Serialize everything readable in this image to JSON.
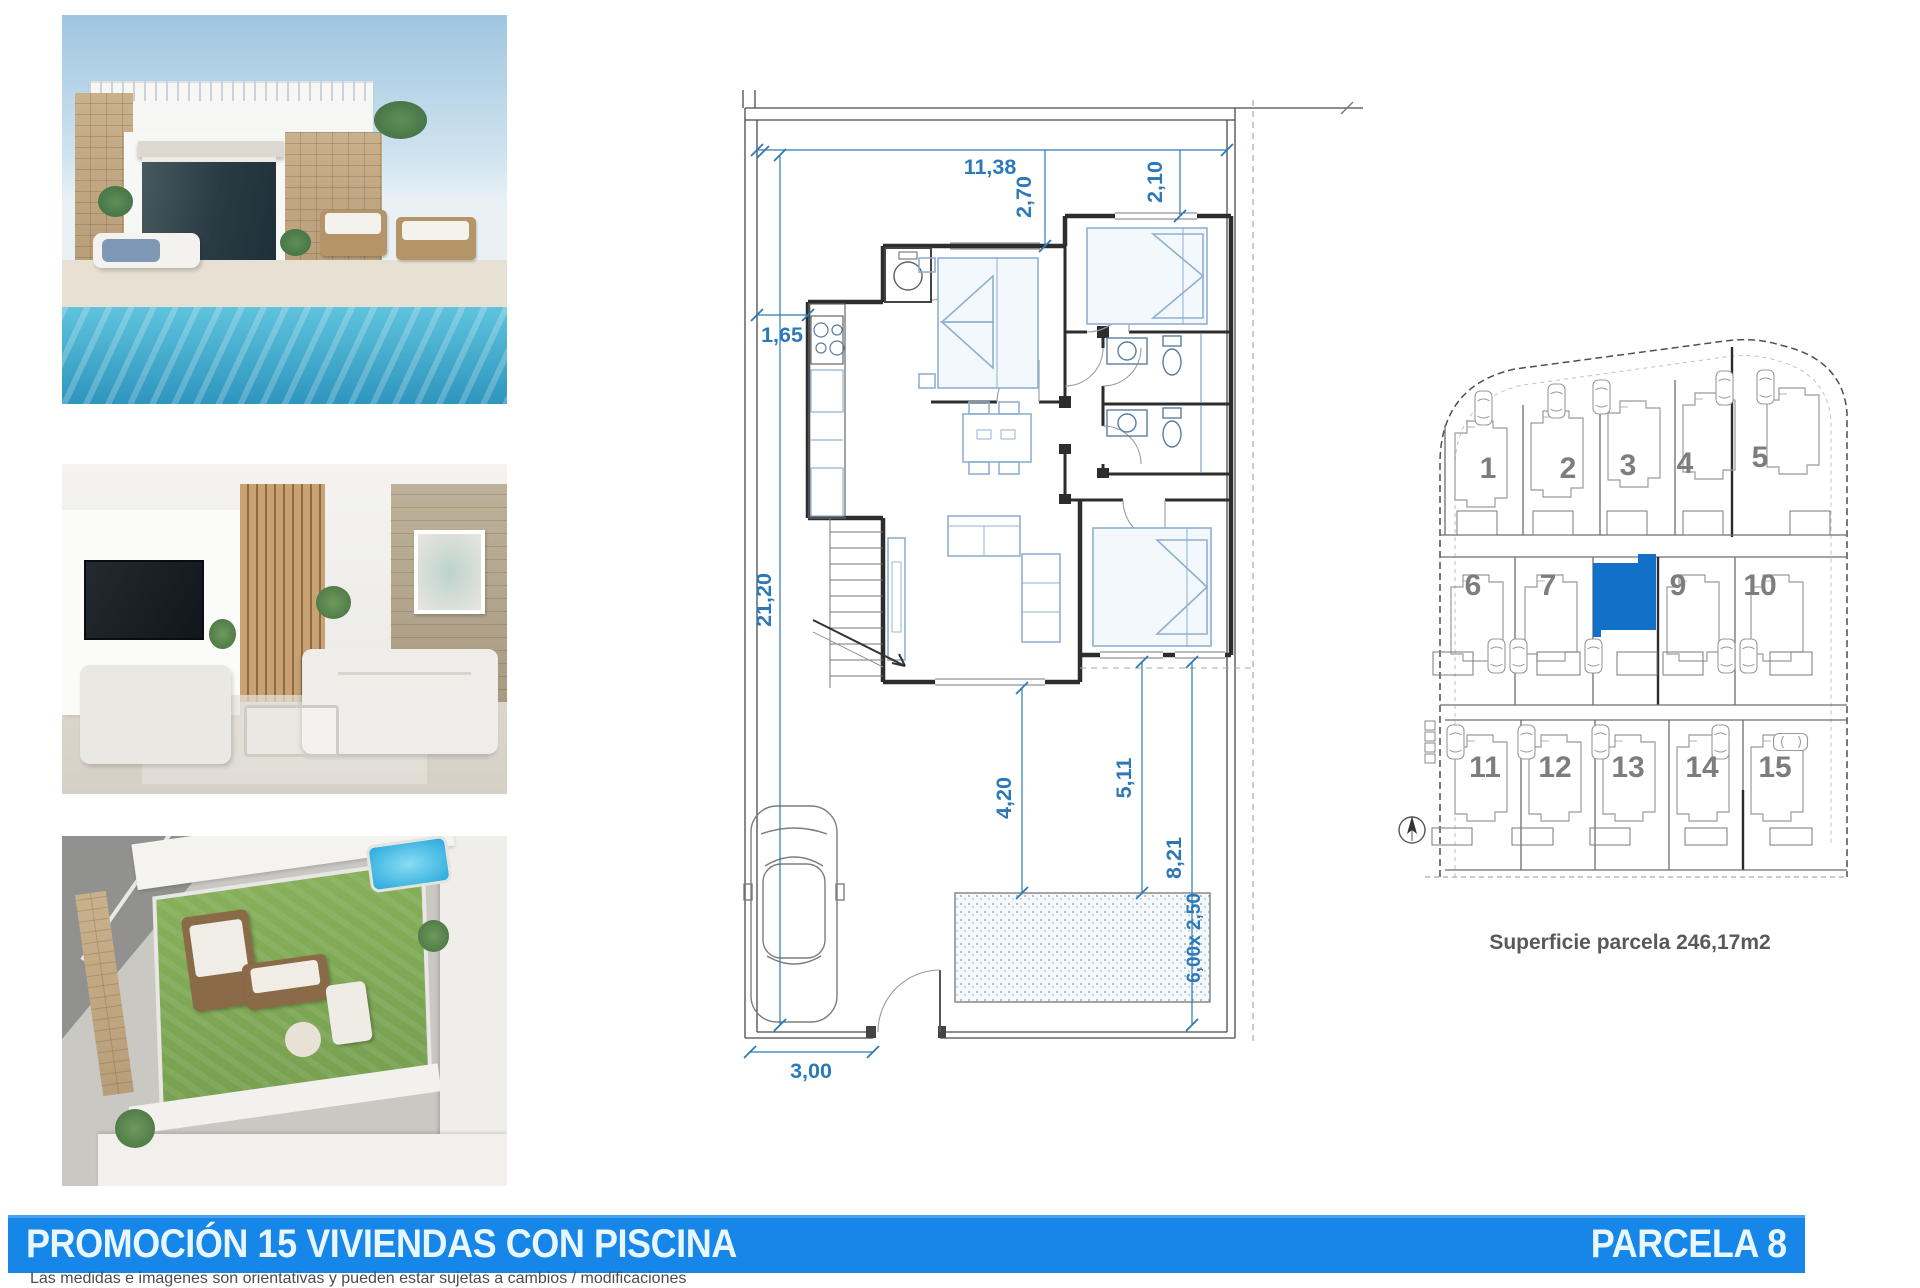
{
  "document": {
    "banner": {
      "title": "PROMOCIÓN 15 VIVIENDAS CON PISCINA",
      "parcel": "PARCELA 8",
      "background": "#1687e8",
      "text_color": "#e8f6fe"
    },
    "disclaimer": "Las medidas e imagenes son orientativas y pueden estar sujetas a cambios / modificaciones"
  },
  "photos": [
    {
      "name": "villa-pool-exterior-render"
    },
    {
      "name": "living-room-interior-render"
    },
    {
      "name": "rooftop-terrace-aerial-render"
    }
  ],
  "floor_plan": {
    "accent_color": "#2d79b8",
    "dimensions": {
      "plot_width_top": "11,38",
      "setback_top_left": "2,70",
      "setback_top_right": "2,10",
      "kitchen_offset_left": "1,65",
      "plot_depth_left": "21,20",
      "house_to_pool": "4,20",
      "pool_offset_side": "5,11",
      "pool_offset_rear": "8,21",
      "pool_size": "6,00x 2,50",
      "gate_width": "3,00"
    }
  },
  "site_plan": {
    "caption": "Superficie parcela 246,17m2",
    "highlighted_parcel": "8",
    "highlight_color": "#1370c8",
    "row1": [
      "1",
      "2",
      "3",
      "4",
      "5"
    ],
    "row2": [
      "6",
      "7",
      "9",
      "10"
    ],
    "row3": [
      "11",
      "12",
      "13",
      "14",
      "15"
    ]
  }
}
